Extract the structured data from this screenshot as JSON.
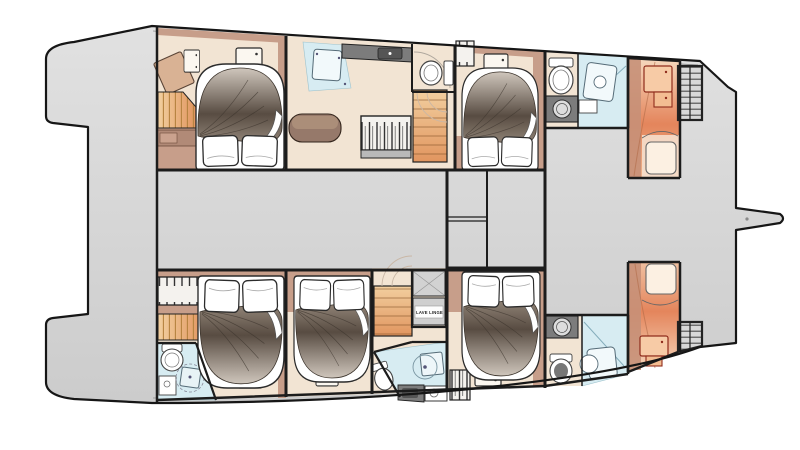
{
  "labels": {
    "laundry": "LAVE LINGE"
  },
  "colors": {
    "background": "#ffffff",
    "hull_deck_light": "#e1e1e1",
    "hull_deck": "#cccccc",
    "outline": "#161616",
    "wall": "#1c1c1c",
    "cabin_floor": "#f2e4d3",
    "trim_band": "#c79e8a",
    "trim_band_dark": "#b18a77",
    "furniture_wood": "#d9b294",
    "stair_orange": "#f2cf9f",
    "stair_orange_deep": "#e1955f",
    "bathroom_blue": "#d7ecf2",
    "shower_tray": "#f2f9fb",
    "counter_gray": "#7c7c7c",
    "wardrobe_white": "#f4f2ee",
    "wardrobe_base": "#b9b9b9",
    "sofa_brown": "#96796a",
    "sofa_cushion": "#ab8e79",
    "bed_white": "#ffffff",
    "duvet_light": "#cfc6bc",
    "duvet_dark": "#584c42",
    "duvet_mid": "#9a8d80",
    "crew_orange_light": "#f6d9be",
    "crew_orange_deep": "#e4855c",
    "crew_trim_brown": "#c69078",
    "crew_accent_red": "#8f2c1c",
    "steps_gray": "#d8d8d8"
  }
}
